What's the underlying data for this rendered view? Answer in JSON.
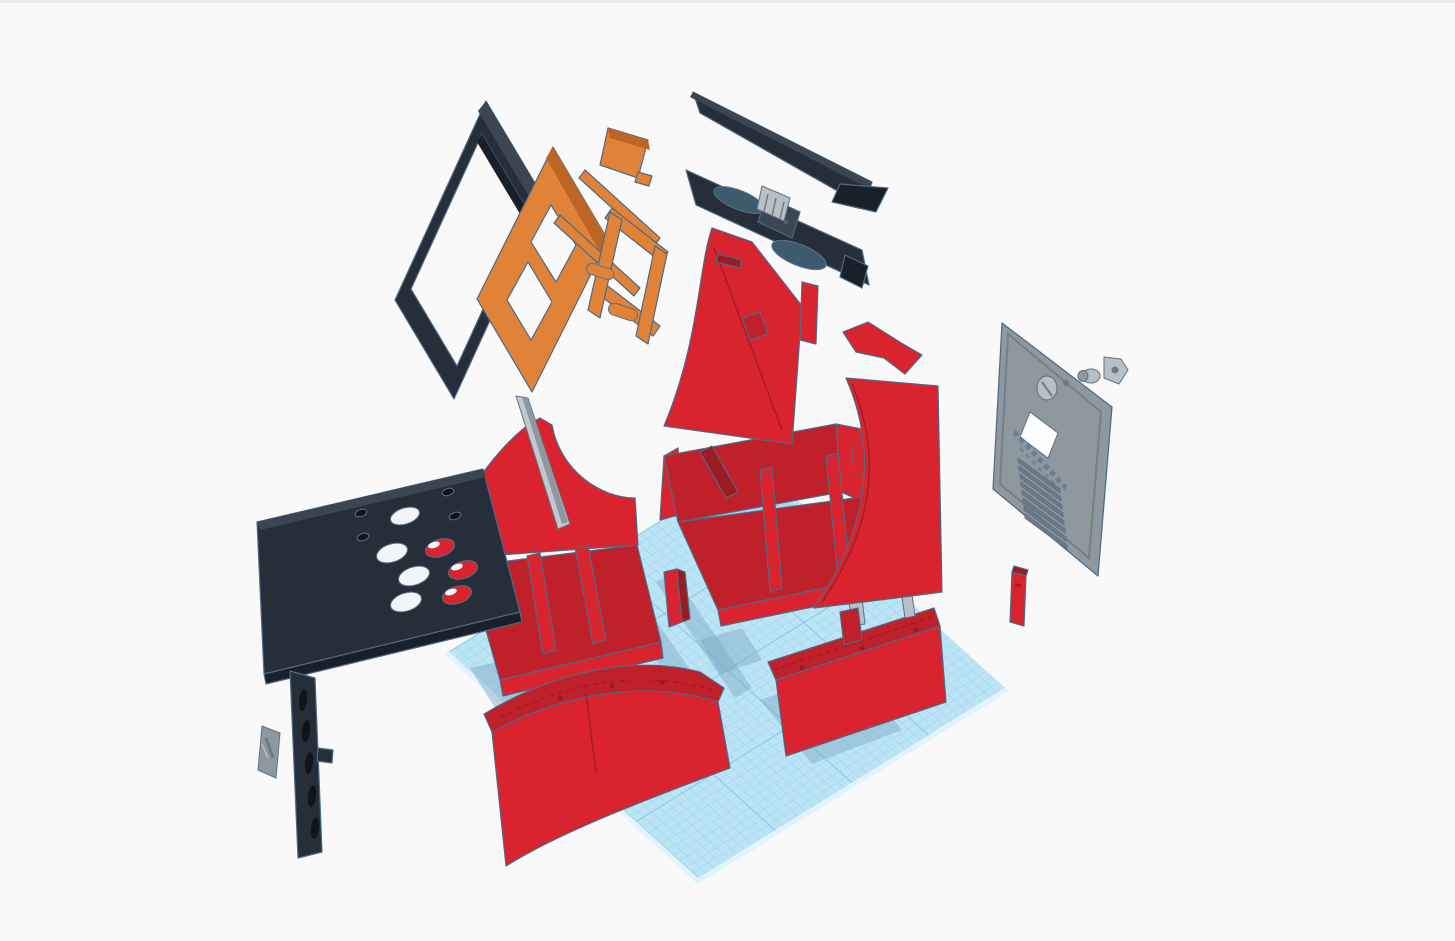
{
  "scene": {
    "app_context": "3d-modeling-canvas",
    "view": "exploded-assembly-of-mini-arcade-cabinet",
    "palette": {
      "bg": "#f9f9f9",
      "top_border": "#e9e9f1",
      "grid": "#bde4f4",
      "grid_line": "#8fd2ee",
      "grid_major": "#7cc5e6",
      "grid_edge": "#dff3fb",
      "shadow": "#7fa9c4",
      "red": "#d9232e",
      "red_mid": "#c0202a",
      "red_dark": "#9a1b22",
      "ink": "#262e39",
      "ink_dark": "#1a202a",
      "ink_lite": "#3a4652",
      "orange": "#e08338",
      "orange_dark": "#bc6524",
      "gray": "#8e989f",
      "gray_light": "#b8c0c6",
      "gray_dark": "#6f7b84",
      "pole": "#c2c8cd",
      "outline": "#4d6a85",
      "outline_soft": "#5d7186",
      "hole_dark": "#10151c",
      "white": "#f2f5f7"
    },
    "workplane": {
      "label": "workplane-grid",
      "shape": "parallelogram",
      "fine_cell_px": 9,
      "major_every": 10
    },
    "parts": [
      {
        "id": "screen-bezel-frame",
        "label": "Screen bezel frame",
        "color_key": "ink"
      },
      {
        "id": "monitor-stand",
        "label": "Monitor stand with legs",
        "color_key": "orange"
      },
      {
        "id": "stand-bracket",
        "label": "Small stand bracket",
        "color_key": "orange"
      },
      {
        "id": "marquee-panel",
        "label": "Marquee top panel",
        "color_key": "ink"
      },
      {
        "id": "marquee-hinge",
        "label": "Marquee hinge block",
        "color_key": "gray_light"
      },
      {
        "id": "speaker-panel",
        "label": "Speaker panel with oval cutouts",
        "color_key": "ink"
      },
      {
        "id": "cabinet-side-left",
        "label": "Left cabinet side panel",
        "color_key": "red"
      },
      {
        "id": "cabinet-side-right",
        "label": "Right cabinet side panel",
        "color_key": "red"
      },
      {
        "id": "side-bracket-strip",
        "label": "Side bracket strip",
        "color_key": "red"
      },
      {
        "id": "support-pole",
        "label": "Support pole",
        "color_key": "pole"
      },
      {
        "id": "bin-left",
        "label": "Left base bin with curved wall",
        "color_key": "red"
      },
      {
        "id": "bin-middle",
        "label": "Middle base bin with dividers",
        "color_key": "red"
      },
      {
        "id": "front-skirt",
        "label": "Curved front skirt panel",
        "color_key": "red"
      },
      {
        "id": "base-box-right",
        "label": "Right base box",
        "color_key": "red"
      },
      {
        "id": "riser-pillar",
        "label": "Small riser pillar",
        "color_key": "red"
      },
      {
        "id": "control-panel",
        "label": "Control panel with button holes",
        "color_key": "ink"
      },
      {
        "id": "control-front-panel",
        "label": "Front panel with vent slots",
        "color_key": "ink"
      },
      {
        "id": "mounting-plate-small",
        "label": "Small mounting plate",
        "color_key": "gray"
      },
      {
        "id": "back-panel",
        "label": "Back access panel (engraved text illegible, window, vents, knob)",
        "color_key": "gray"
      },
      {
        "id": "lock-barrel",
        "label": "Lock barrel",
        "color_key": "gray"
      },
      {
        "id": "lock-plate",
        "label": "Lock plate",
        "color_key": "gray"
      },
      {
        "id": "access-door-small",
        "label": "Small access door",
        "color_key": "red"
      },
      {
        "id": "support-posts",
        "label": "Gray support posts",
        "color_key": "gray_light"
      }
    ]
  }
}
